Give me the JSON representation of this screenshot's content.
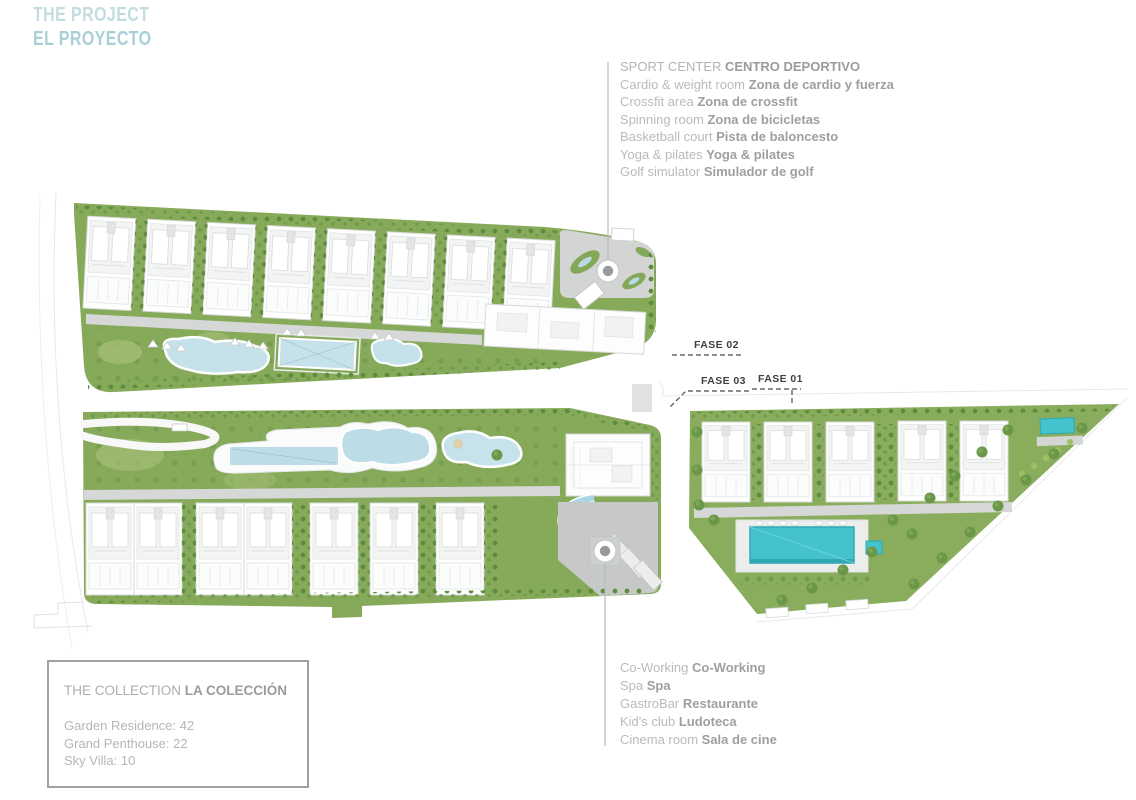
{
  "header": {
    "title_en": "THE PROJECT",
    "title_es": "EL PROYECTO"
  },
  "sport_center": {
    "title_en": "SPORT CENTER",
    "title_es": "CENTRO DEPORTIVO",
    "items": [
      {
        "en": "Cardio & weight room",
        "es": "Zona de cardio y fuerza"
      },
      {
        "en": "Crossfit area",
        "es": "Zona de crossfit"
      },
      {
        "en": "Spinning room",
        "es": "Zona de bicicletas"
      },
      {
        "en": "Basketball court",
        "es": "Pista de baloncesto"
      },
      {
        "en": "Yoga & pilates",
        "es": "Yoga & pilates"
      },
      {
        "en": "Golf simulator",
        "es": "Simulador de golf"
      }
    ]
  },
  "amenities": {
    "items": [
      {
        "en": "Co-Working",
        "es": "Co-Working"
      },
      {
        "en": "Spa",
        "es": "Spa"
      },
      {
        "en": "GastroBar",
        "es": "Restaurante"
      },
      {
        "en": "Kid's club",
        "es": "Ludoteca"
      },
      {
        "en": "Cinema room",
        "es": "Sala de cine"
      }
    ]
  },
  "collection": {
    "title_en": "THE COLLECTION",
    "title_es": "LA COLECCIÓN",
    "items": [
      "Garden Residence: 42",
      "Grand Penthouse: 22",
      "Sky Villa: 10"
    ]
  },
  "phases": {
    "fase_01": "FASE 01",
    "fase_02": "FASE 02",
    "fase_03": "FASE 03"
  },
  "map_icons": {
    "sport_center_marker": "target-circle-marker",
    "club_marker": "target-circle-marker"
  },
  "colors": {
    "title_blue": "#bcd8dd",
    "text_gray": "#b9baba",
    "text_gray_bold": "#9e9fa0",
    "phase_label": "#414141",
    "landscape_green": "#86aa59",
    "tree_green": "#5f8f41",
    "pool_light_blue": "#c5e2ea",
    "pool_teal": "#45c3cc",
    "road_gray": "#d5d8d7",
    "plaza_gray": "#c6c9c8"
  }
}
